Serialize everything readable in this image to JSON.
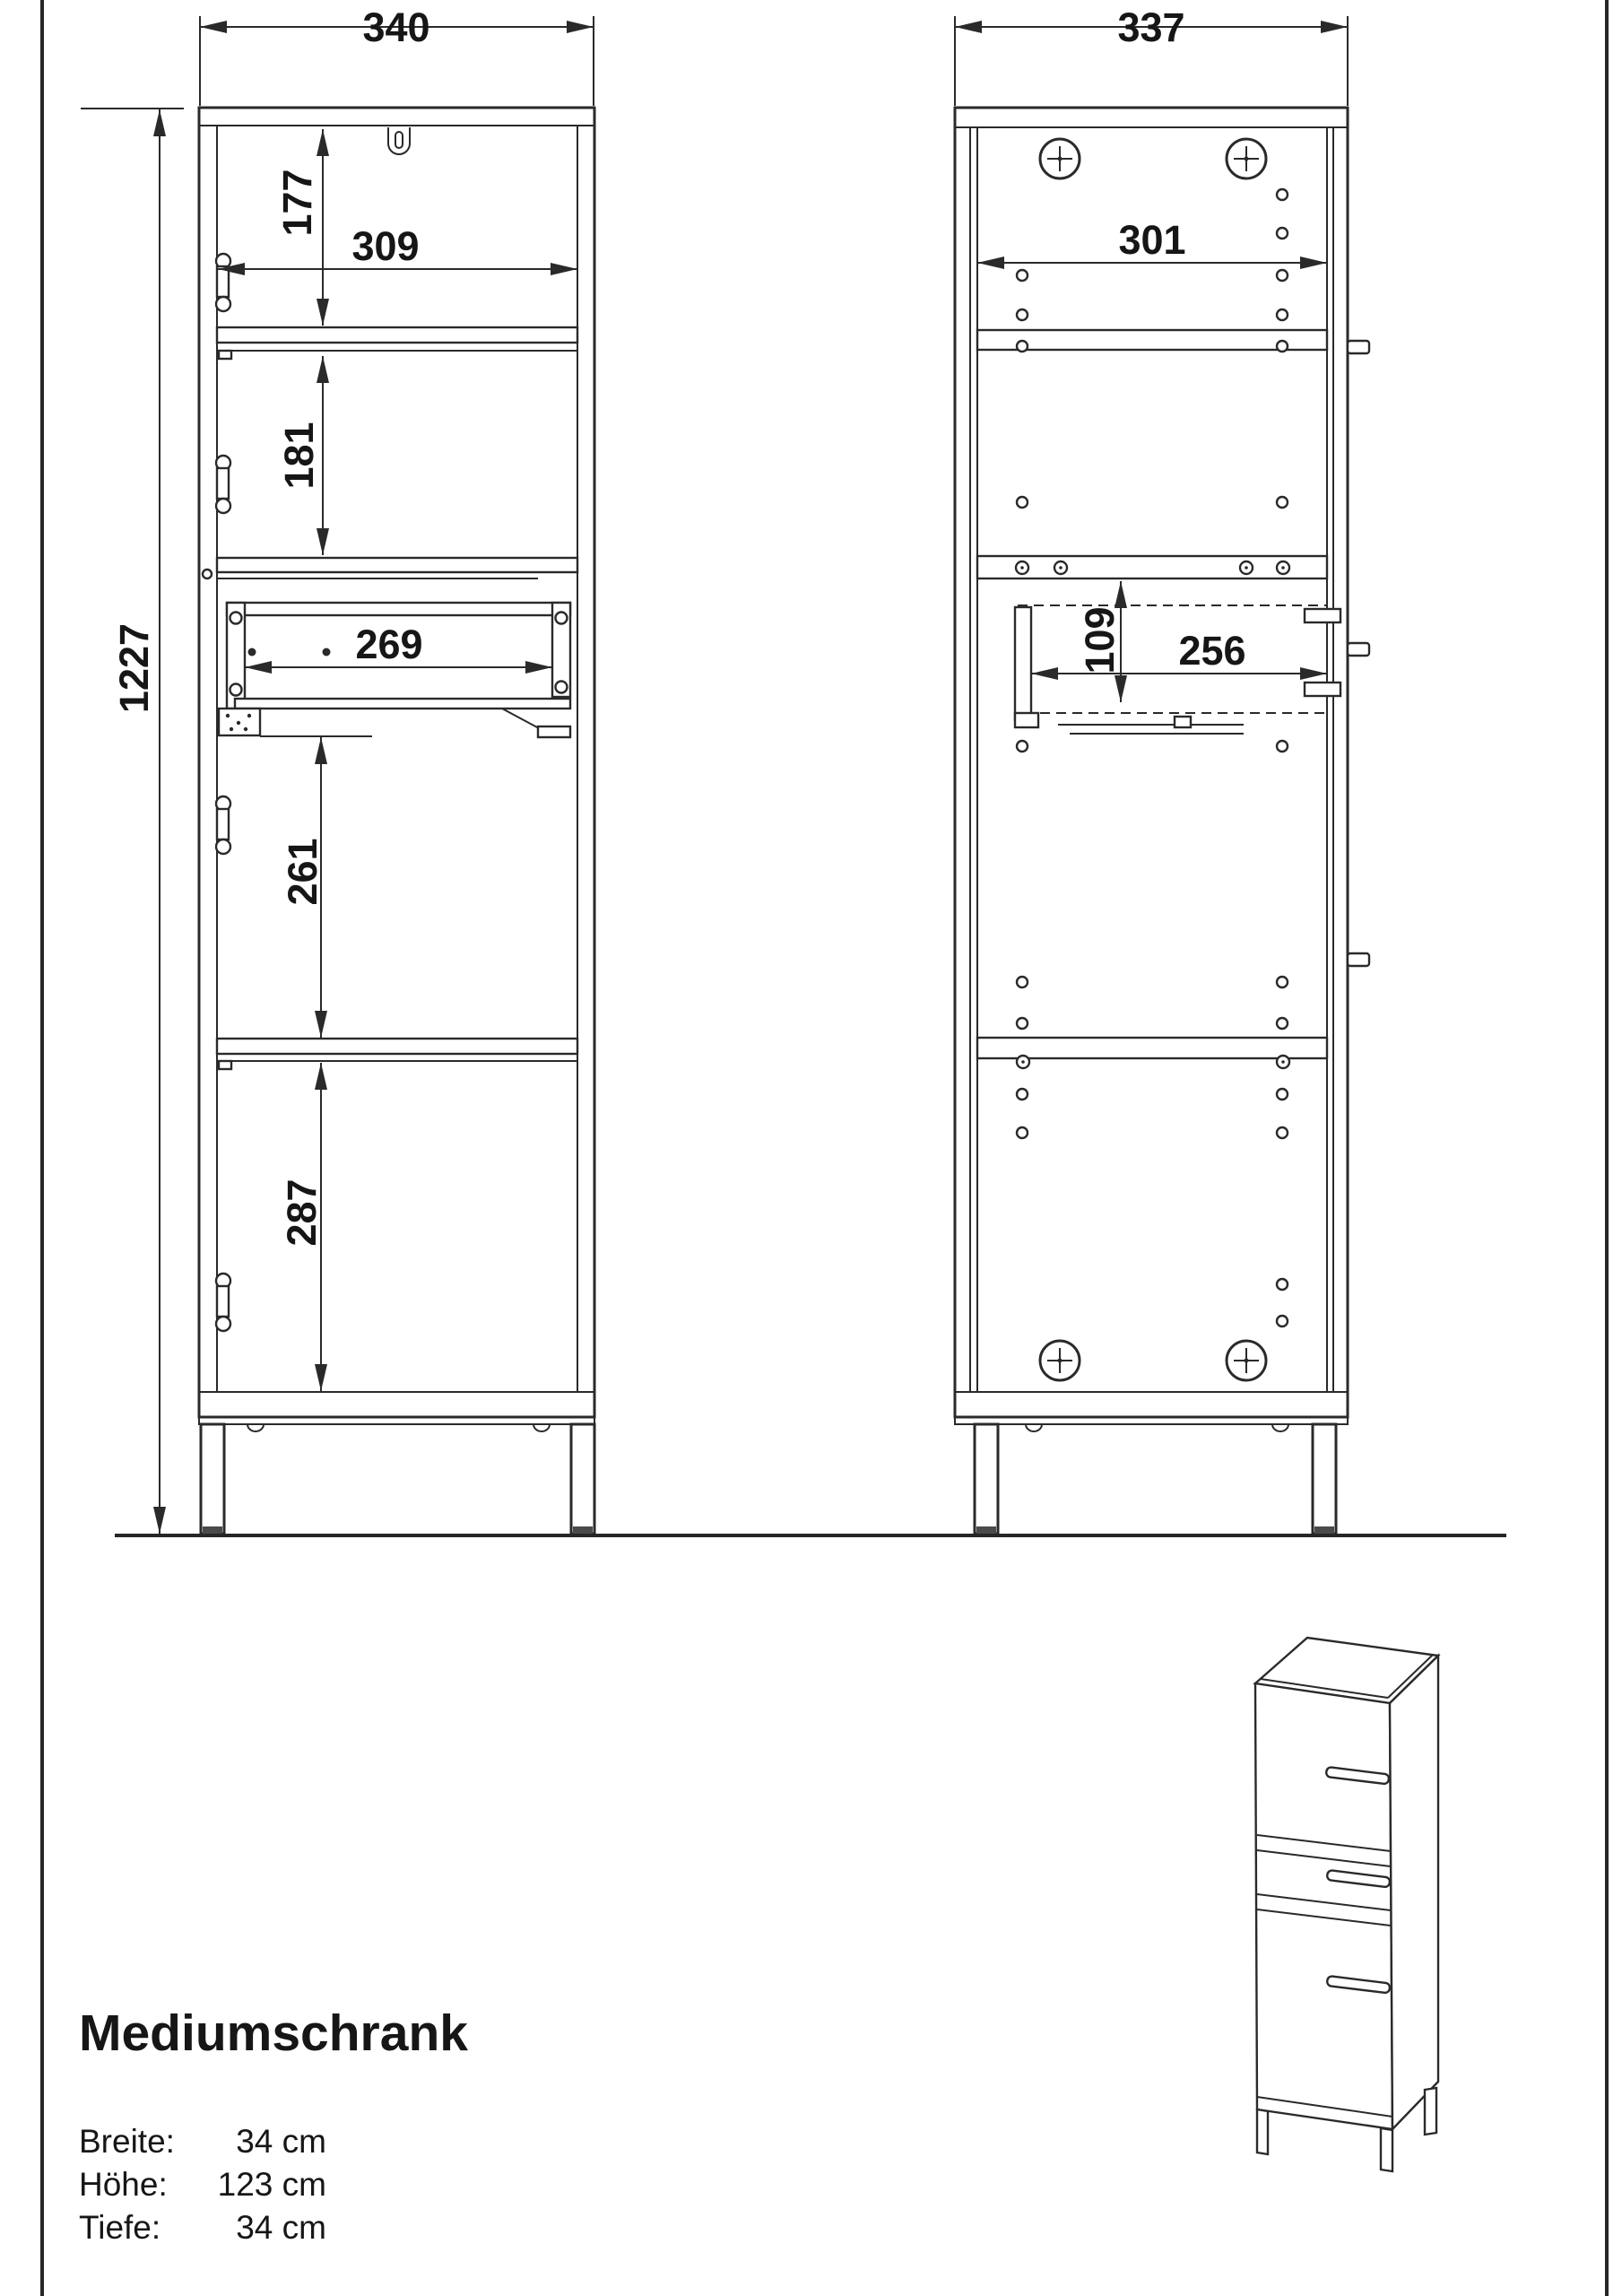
{
  "page": {
    "title": "Mediumschrank"
  },
  "specs": {
    "rows": [
      {
        "label": "Breite:",
        "value": "34 cm"
      },
      {
        "label": "Höhe:",
        "value": "123 cm"
      },
      {
        "label": "Tiefe:",
        "value": "34 cm"
      }
    ]
  },
  "views": {
    "front_section": {
      "dims": {
        "width": "340",
        "height": "1227",
        "top_offset": "177",
        "inner_width": "309",
        "upper_door": "181",
        "drawer_width": "269",
        "middle": "261",
        "bottom": "287"
      }
    },
    "rear_section": {
      "dims": {
        "width": "337",
        "inner_width": "301",
        "drawer_height": "109",
        "drawer_width": "256"
      }
    }
  },
  "colors": {
    "line": "#2a2a2a",
    "text": "#161616",
    "background": "#ffffff"
  }
}
